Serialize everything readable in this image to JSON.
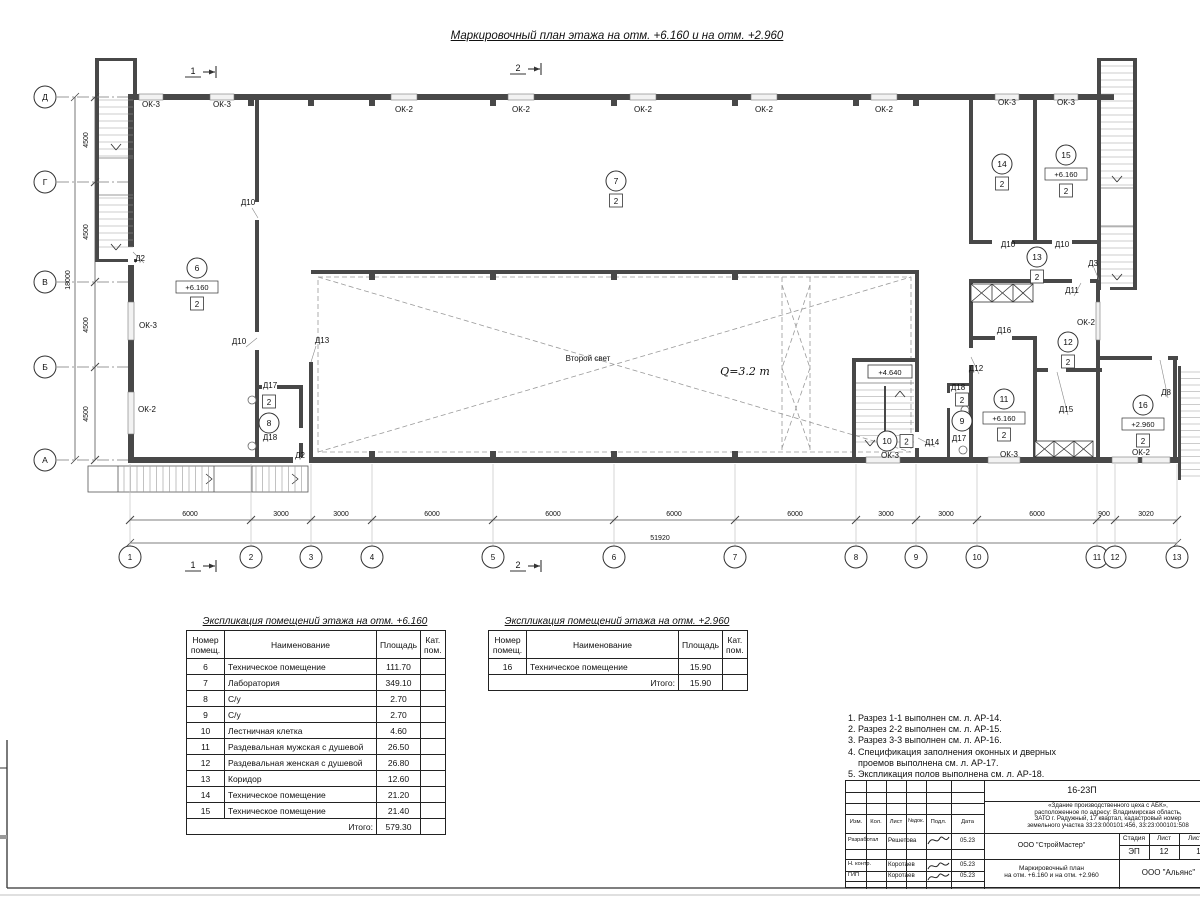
{
  "sheet": {
    "title": "Маркировочный план этажа на отм. +6.160 и на отм. +2.960"
  },
  "plan": {
    "row_axes": [
      {
        "label": "Д",
        "y": 97
      },
      {
        "label": "Г",
        "y": 182
      },
      {
        "label": "В",
        "y": 282
      },
      {
        "label": "Б",
        "y": 367
      },
      {
        "label": "А",
        "y": 460
      }
    ],
    "row_dims": [
      {
        "text": "4500",
        "y": 140
      },
      {
        "text": "4500",
        "y": 232
      },
      {
        "text": "4500",
        "y": 325
      },
      {
        "text": "4500",
        "y": 414
      }
    ],
    "row_total_dim": {
      "text": "18000",
      "x": 70,
      "y": 280
    },
    "col_axes": [
      {
        "label": "1",
        "x": 130
      },
      {
        "label": "2",
        "x": 251
      },
      {
        "label": "3",
        "x": 311
      },
      {
        "label": "4",
        "x": 372
      },
      {
        "label": "5",
        "x": 493
      },
      {
        "label": "6",
        "x": 614
      },
      {
        "label": "7",
        "x": 735
      },
      {
        "label": "8",
        "x": 856
      },
      {
        "label": "9",
        "x": 916
      },
      {
        "label": "10",
        "x": 977
      },
      {
        "label": "11",
        "x": 1097
      },
      {
        "label": "12",
        "x": 1115
      },
      {
        "label": "13",
        "x": 1177
      }
    ],
    "col_dims": [
      {
        "text": "6000",
        "x": 190
      },
      {
        "text": "3000",
        "x": 281
      },
      {
        "text": "3000",
        "x": 341
      },
      {
        "text": "6000",
        "x": 432
      },
      {
        "text": "6000",
        "x": 553
      },
      {
        "text": "6000",
        "x": 674
      },
      {
        "text": "6000",
        "x": 795
      },
      {
        "text": "3000",
        "x": 886
      },
      {
        "text": "3000",
        "x": 946
      },
      {
        "text": "6000",
        "x": 1037
      },
      {
        "text": "900",
        "x": 1104
      },
      {
        "text": "3020",
        "x": 1146
      }
    ],
    "col_total_dim": {
      "text": "51920",
      "x": 660,
      "y": 540
    },
    "section_marks": [
      {
        "text": "1",
        "x": 193,
        "y": 74
      },
      {
        "text": "2",
        "x": 518,
        "y": 71
      },
      {
        "text": "1",
        "x": 193,
        "y": 568
      },
      {
        "text": "2",
        "x": 518,
        "y": 568
      }
    ],
    "labels": [
      {
        "text": "ОК-3",
        "x": 151,
        "y": 107
      },
      {
        "text": "ОК-3",
        "x": 222,
        "y": 107
      },
      {
        "text": "ОК-2",
        "x": 404,
        "y": 112
      },
      {
        "text": "ОК-2",
        "x": 521,
        "y": 112
      },
      {
        "text": "ОК-2",
        "x": 643,
        "y": 112
      },
      {
        "text": "ОК-2",
        "x": 764,
        "y": 112
      },
      {
        "text": "ОК-2",
        "x": 884,
        "y": 112
      },
      {
        "text": "ОК-3",
        "x": 1007,
        "y": 105
      },
      {
        "text": "ОК-3",
        "x": 1066,
        "y": 105
      },
      {
        "text": "Д2",
        "x": 140,
        "y": 261
      },
      {
        "text": "ОК-3",
        "x": 148,
        "y": 328
      },
      {
        "text": "ОК-2",
        "x": 147,
        "y": 412
      },
      {
        "text": "Д10",
        "x": 248,
        "y": 205
      },
      {
        "text": "Д10",
        "x": 239,
        "y": 344
      },
      {
        "text": "Д13",
        "x": 322,
        "y": 343
      },
      {
        "text": "Д17",
        "x": 270,
        "y": 388
      },
      {
        "text": "Д18",
        "x": 270,
        "y": 440
      },
      {
        "text": "Д2",
        "x": 300,
        "y": 458
      },
      {
        "text": "Д14",
        "x": 932,
        "y": 445
      },
      {
        "text": "ОК-3",
        "x": 890,
        "y": 458
      },
      {
        "text": "Д18",
        "x": 958,
        "y": 390
      },
      {
        "text": "Д17",
        "x": 959,
        "y": 441
      },
      {
        "text": "Д12",
        "x": 976,
        "y": 371
      },
      {
        "text": "Д16",
        "x": 1004,
        "y": 333
      },
      {
        "text": "Д10",
        "x": 1008,
        "y": 247
      },
      {
        "text": "Д10",
        "x": 1062,
        "y": 247
      },
      {
        "text": "Д3",
        "x": 1093,
        "y": 266
      },
      {
        "text": "Д11",
        "x": 1072,
        "y": 293
      },
      {
        "text": "ОК-2",
        "x": 1086,
        "y": 325
      },
      {
        "text": "Д15",
        "x": 1066,
        "y": 412
      },
      {
        "text": "ОК-3",
        "x": 1009,
        "y": 457
      },
      {
        "text": "ОК-2",
        "x": 1141,
        "y": 455
      },
      {
        "text": "Д8",
        "x": 1166,
        "y": 395
      }
    ],
    "annotations": [
      {
        "text": "Второй свет",
        "x": 588,
        "y": 361,
        "size": 8
      },
      {
        "text": "Q=3.2 т",
        "x": 745,
        "y": 375,
        "size": 11,
        "serif": true
      },
      {
        "text": "+4.640",
        "x": 890,
        "y": 375,
        "size": 7.5,
        "boxed": true
      }
    ],
    "room_markers": [
      {
        "num": "6",
        "x": 197,
        "y": 268,
        "level": "+6.160",
        "cat": "2"
      },
      {
        "num": "7",
        "x": 616,
        "y": 181,
        "cat": "2"
      },
      {
        "num": "8",
        "x": 269,
        "y": 423,
        "cat": "2",
        "cat_pos": "above"
      },
      {
        "num": "9",
        "x": 962,
        "y": 421,
        "cat": "2",
        "cat_pos": "above"
      },
      {
        "num": "10",
        "x": 887,
        "y": 441,
        "cat": "2",
        "cat_pos": "right"
      },
      {
        "num": "11",
        "x": 1004,
        "y": 399,
        "level": "+6.160",
        "cat": "2"
      },
      {
        "num": "12",
        "x": 1068,
        "y": 342,
        "cat": "2"
      },
      {
        "num": "13",
        "x": 1037,
        "y": 257,
        "cat": "2"
      },
      {
        "num": "14",
        "x": 1002,
        "y": 164,
        "cat": "2"
      },
      {
        "num": "15",
        "x": 1066,
        "y": 155,
        "level": "+6.160",
        "cat": "2"
      },
      {
        "num": "16",
        "x": 1143,
        "y": 405,
        "level": "+2.960",
        "cat": "2"
      }
    ]
  },
  "tables": [
    {
      "title": "Экспликация помещений этажа на отм. +6.160",
      "headers": [
        "Номер помещ.",
        "Наименование",
        "Площадь",
        "Кат. пом."
      ],
      "rows": [
        [
          "6",
          "Техническое помещение",
          "111.70",
          ""
        ],
        [
          "7",
          "Лаборатория",
          "349.10",
          ""
        ],
        [
          "8",
          "С/у",
          "2.70",
          ""
        ],
        [
          "9",
          "С/у",
          "2.70",
          ""
        ],
        [
          "10",
          "Лестничная клетка",
          "4.60",
          ""
        ],
        [
          "11",
          "Раздевальная мужская с душевой",
          "26.50",
          ""
        ],
        [
          "12",
          "Раздевальная женская с душевой",
          "26.80",
          ""
        ],
        [
          "13",
          "Коридор",
          "12.60",
          ""
        ],
        [
          "14",
          "Техническое помещение",
          "21.20",
          ""
        ],
        [
          "15",
          "Техническое помещение",
          "21.40",
          ""
        ]
      ],
      "total_label": "Итого:",
      "total_value": "579.30"
    },
    {
      "title": "Экспликация помещений этажа на отм. +2.960",
      "headers": [
        "Номер помещ.",
        "Наименование",
        "Площадь",
        "Кат. пом."
      ],
      "rows": [
        [
          "16",
          "Техническое помещение",
          "15.90",
          ""
        ]
      ],
      "total_label": "Итого:",
      "total_value": "15.90"
    }
  ],
  "notes": {
    "lines": [
      "1. Разрез 1-1 выполнен см. л. АР-14.",
      "2. Разрез 2-2 выполнен см. л. АР-15.",
      "3. Разрез 3-3 выполнен см. л. АР-16.",
      "4. Спецификация заполнения оконных и дверных",
      "    проемов выполнена см. л. АР-17.",
      "5. Экспликация полов выполнена см. л. АР-18."
    ]
  },
  "titleblock": {
    "doc_number": "16-23П",
    "object_desc_lines": [
      "«Здание производственного цеха с АБК»,",
      "расположенное по адресу: Владимирская область,",
      "ЗАТО г. Радужный, 17 квартал, кадастровый номер",
      "земельного участка 33:23:000101:456, 33:23:000101:508"
    ],
    "header_cols": [
      "Изм.",
      "Кол.",
      "Лист",
      "№док.",
      "Подл.",
      "Дата"
    ],
    "sign_rows": [
      {
        "role": "Разработал",
        "name": "Решетова",
        "date": "05.23"
      },
      {
        "role": "Н. контр.",
        "name": "Коротаев",
        "date": "05.23"
      },
      {
        "role": "ГИП",
        "name": "Коротаев",
        "date": "05.23"
      }
    ],
    "company": "ООО \"СтройМастер\"",
    "stage_label": "Стадия",
    "sheet_label": "Лист",
    "sheets_label": "Листов",
    "stage": "ЭП",
    "sheet": "12",
    "sheets": "1",
    "drawing_title_lines": [
      "Маркировочный план",
      "на отм. +6.160 и на отм. +2.960"
    ],
    "org": "ООО \"Альянс\""
  }
}
